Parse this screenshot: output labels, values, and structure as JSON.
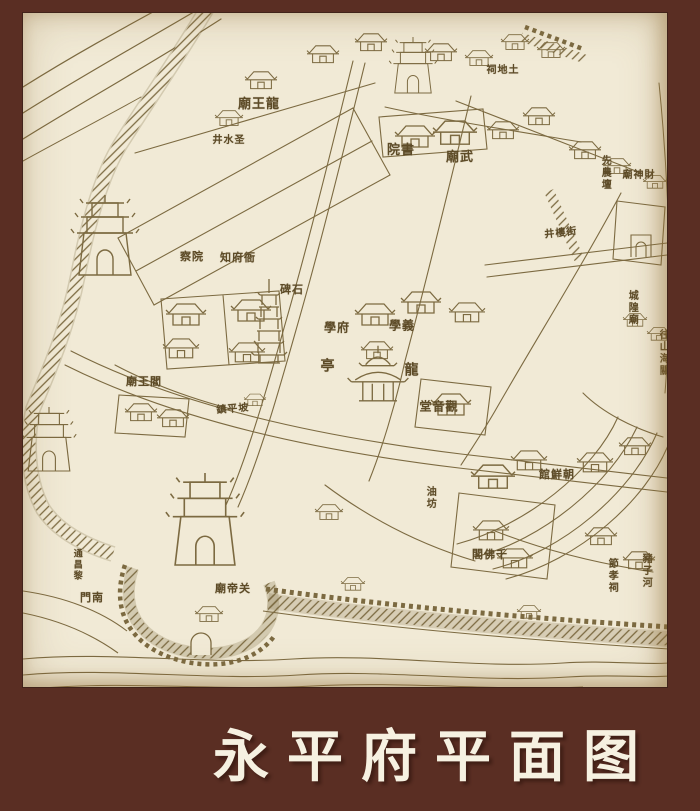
{
  "frame": {
    "background_color": "#5a2e23",
    "title": "永平府平面图",
    "title_color": "#f6f1e1"
  },
  "map": {
    "background_color": "#f1ead6",
    "ink_color": "#7c6a41",
    "label_color": "#5d4b27",
    "labels": [
      {
        "name": "label-longwangmiao",
        "text": "廟王龍",
        "x": 236,
        "y": 92,
        "size": 13
      },
      {
        "name": "label-shengshuijing",
        "text": "井水圣",
        "x": 206,
        "y": 128,
        "size": 10
      },
      {
        "name": "label-shuyuan",
        "text": "院書",
        "x": 378,
        "y": 138,
        "size": 13
      },
      {
        "name": "label-wumiao",
        "text": "廟武",
        "x": 437,
        "y": 145,
        "size": 13
      },
      {
        "name": "label-caishenmiao",
        "text": "廟神財",
        "x": 616,
        "y": 163,
        "size": 10
      },
      {
        "name": "label-tudici",
        "text": "祠地土",
        "x": 480,
        "y": 58,
        "size": 10
      },
      {
        "name": "label-chayuan",
        "text": "察院",
        "x": 169,
        "y": 244,
        "size": 11
      },
      {
        "name": "label-zhifuya",
        "text": "知府衙",
        "x": 215,
        "y": 245,
        "size": 11
      },
      {
        "name": "label-shibei",
        "text": "碑石",
        "x": 269,
        "y": 277,
        "size": 11
      },
      {
        "name": "label-fuxue",
        "text": "學府",
        "x": 314,
        "y": 315,
        "size": 12
      },
      {
        "name": "label-yixue",
        "text": "學義",
        "x": 379,
        "y": 313,
        "size": 12
      },
      {
        "name": "label-ting",
        "text": "亭",
        "x": 305,
        "y": 354,
        "size": 14
      },
      {
        "name": "label-long",
        "text": "龍",
        "x": 389,
        "y": 358,
        "size": 14
      },
      {
        "name": "label-guanyintang",
        "text": "堂音觀",
        "x": 416,
        "y": 394,
        "size": 12
      },
      {
        "name": "label-yanwangmiao",
        "text": "廟王閻",
        "x": 121,
        "y": 369,
        "size": 11
      },
      {
        "name": "label-zhenpingpo",
        "text": "鎮平坡",
        "x": 210,
        "y": 397,
        "size": 10,
        "rotate": -5
      },
      {
        "name": "label-jingloujie",
        "text": "井樓街",
        "x": 538,
        "y": 221,
        "size": 10,
        "rotate": -6
      },
      {
        "name": "label-xiannongtan",
        "text": "先農壇",
        "x": 581,
        "y": 160,
        "size": 10,
        "vertical": true
      },
      {
        "name": "label-chenghuangmiao",
        "text": "城隍廟",
        "x": 608,
        "y": 295,
        "size": 10,
        "vertical": true
      },
      {
        "name": "label-wangshanhaiguan",
        "text": "往山海關",
        "x": 639,
        "y": 340,
        "size": 10,
        "vertical": true
      },
      {
        "name": "label-chaoxianguan",
        "text": "館鮮朝",
        "x": 534,
        "y": 462,
        "size": 11
      },
      {
        "name": "label-youfang",
        "text": "油坊",
        "x": 406,
        "y": 485,
        "size": 10,
        "vertical": true
      },
      {
        "name": "label-qianfoge",
        "text": "閣佛千",
        "x": 467,
        "y": 542,
        "size": 11
      },
      {
        "name": "label-jiexiaoci",
        "text": "節孝祠",
        "x": 588,
        "y": 563,
        "size": 10,
        "vertical": true
      },
      {
        "name": "label-zhuzihe",
        "text": "豬子河",
        "x": 622,
        "y": 558,
        "size": 10,
        "vertical": true
      },
      {
        "name": "label-guandimiao",
        "text": "廟帝关",
        "x": 210,
        "y": 576,
        "size": 11
      },
      {
        "name": "label-nanmen",
        "text": "門南",
        "x": 69,
        "y": 585,
        "size": 11
      },
      {
        "name": "label-tongchangli",
        "text": "通昌黎",
        "x": 53,
        "y": 552,
        "size": 9,
        "vertical": true
      }
    ]
  }
}
